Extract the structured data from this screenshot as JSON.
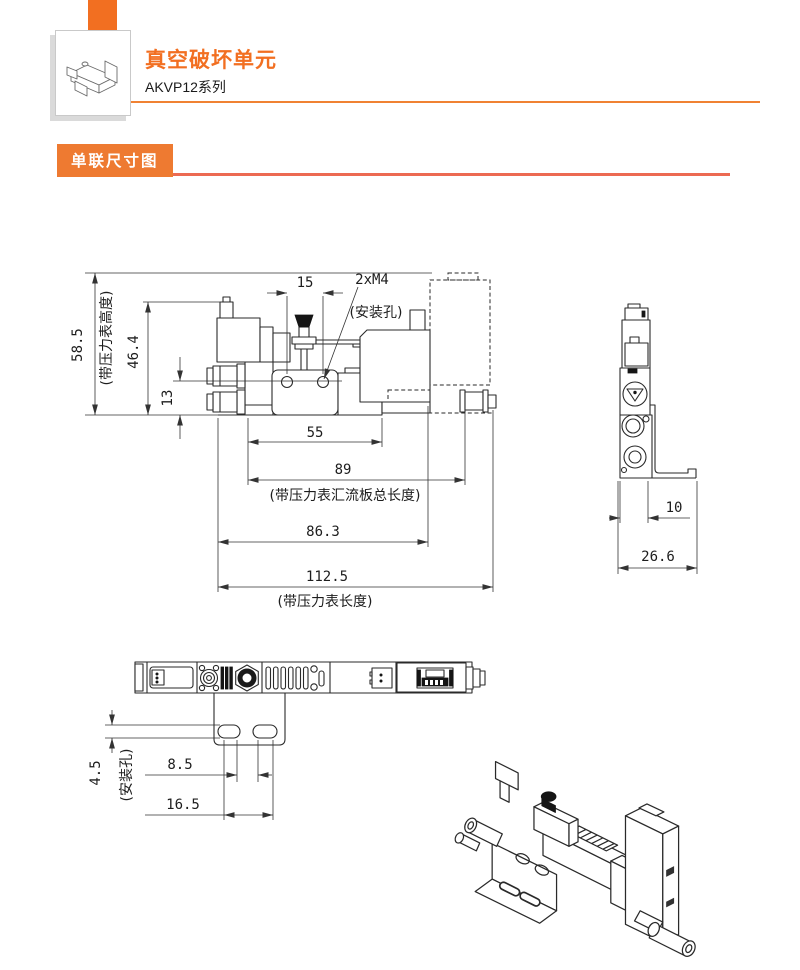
{
  "header": {
    "title": "真空破坏单元",
    "subtitle": "AKVP12系列"
  },
  "section": {
    "label": "单联尺寸图"
  },
  "colors": {
    "accent": "#f26f21",
    "header_rule": "#f08233",
    "section_chip": "#ee7a31",
    "section_underline": "#ec6a52",
    "drawing_line": "#2a2a2a"
  },
  "front_view": {
    "dims": {
      "overall_height": "58.5",
      "overall_height_note": "(带压力表高度)",
      "body_height": "46.4",
      "port_offset": "13",
      "hole_pitch": "15",
      "hole_spec": "2xM4",
      "hole_note": "(安装孔)",
      "manifold_len": "55",
      "len_89": "89",
      "len_89_note": "(带压力表汇流板总长度)",
      "len_86_3": "86.3",
      "len_112_5": "112.5",
      "len_112_5_note": "(带压力表长度)"
    }
  },
  "side_view": {
    "dims": {
      "body_width": "10",
      "overall_width": "26.6"
    }
  },
  "bottom_view": {
    "dims": {
      "slot_width": "4.5",
      "slot_note": "(安装孔)",
      "slot_pitch": "8.5",
      "slot_span": "16.5"
    }
  }
}
